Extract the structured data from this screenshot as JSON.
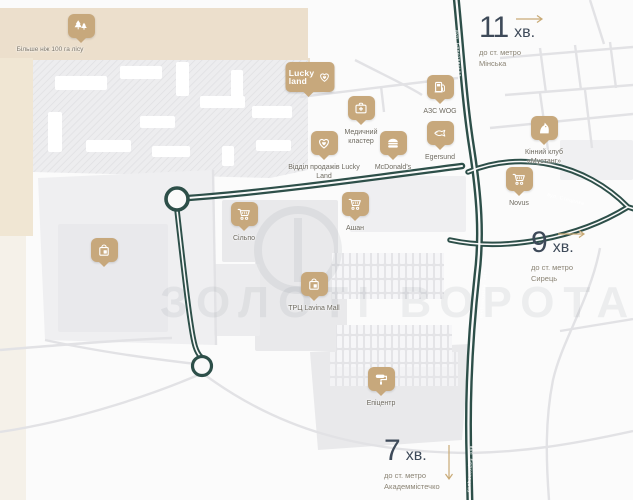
{
  "colors": {
    "accent": "#c7a87c",
    "road_green": "#2d4f49",
    "number_navy": "#3e4a59",
    "arrow_gold": "#c9aa76",
    "beige": "#ecdfcc"
  },
  "forest": {
    "label": "Більше ніж 100 га лісу"
  },
  "logo": {
    "line1": "Lucky",
    "line2": "land"
  },
  "markers": [
    {
      "id": "silpo",
      "icon": "cart-icon",
      "label": "Сільпо"
    },
    {
      "id": "ashan",
      "icon": "cart-icon",
      "label": "Ашан"
    },
    {
      "id": "novus",
      "icon": "cart-icon",
      "label": "Novus"
    },
    {
      "id": "lavina",
      "icon": "bag-icon",
      "label": "ТРЦ Lavina Mall"
    },
    {
      "id": "epicentr",
      "icon": "roller-icon",
      "label": "Епіцентр"
    },
    {
      "id": "mcdonalds",
      "icon": "burger-icon",
      "label": "McDonald's"
    },
    {
      "id": "egersund",
      "icon": "fish-icon",
      "label": "Egersund"
    },
    {
      "id": "azs-wog",
      "icon": "fuel-icon",
      "label": "АЗС WOG"
    },
    {
      "id": "medical",
      "icon": "medical-case-icon",
      "label": "Медичний кластер"
    },
    {
      "id": "sales-office",
      "icon": "heart-icon",
      "label": "Відділ продажів Lucky Land"
    },
    {
      "id": "mustang",
      "icon": "horse-icon",
      "label": "Кінний клуб «Мустанг»"
    },
    {
      "id": "mall-bag",
      "icon": "bag-icon",
      "label": ""
    }
  ],
  "travel_times": [
    {
      "id": "minska",
      "minutes": "11",
      "unit": "хв.",
      "prefix": "до ст. метро",
      "station": "Мінська",
      "direction": "right"
    },
    {
      "id": "syrets",
      "minutes": "9",
      "unit": "хв.",
      "prefix": "до ст. метро",
      "station": "Сирець",
      "direction": "right"
    },
    {
      "id": "akademmistechko",
      "minutes": "7",
      "unit": "хв.",
      "prefix": "до ст. метро",
      "station": "Академмістечко",
      "direction": "down"
    }
  ],
  "roads": {
    "main": "вул. Берковецька",
    "east": "вул. Стеценка"
  },
  "watermark": {
    "text": "ЗОЛОТІ ВОРОТА"
  }
}
